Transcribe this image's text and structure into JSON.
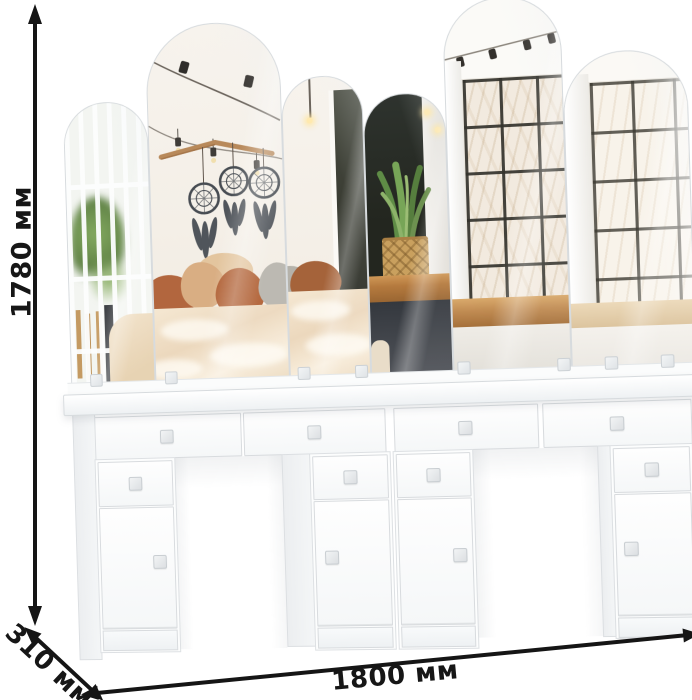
{
  "image_type": "furniture product photo with dimension annotations",
  "dimensions": {
    "height_label": "1780 мм",
    "depth_label": "310 мм",
    "width_label": "1800 мм"
  },
  "product": {
    "kind": "white double dressing table (vanity) with arched mirror panels",
    "mirror_panels": 6,
    "apron_drawers": 4,
    "pedestals": 4,
    "pedestal_drawers": 4,
    "pedestal_doors": 4,
    "knob_style": "small square acrylic knobs"
  },
  "reflection_scene": {
    "left": "white slatted screen with green houseplant and bamboo poles",
    "center": "white brick wall, string lights, wooden branch with three dreamcatchers, bed with beige and terracotta pillows",
    "right": "dark wall, snake plant in wicker basket on wooden window bench, black grid window with pale trees outside"
  },
  "colors": {
    "background": "#ffffff",
    "furniture_white": "#fcfdfd",
    "outline_gray": "#d8dbde",
    "dimension_line": "#151515",
    "mirror_wall": "#f5f1ea",
    "dark_wall": "#2a2e2a",
    "wood_bench": "#b5763c",
    "branch_wood": "#b8895a",
    "plant_green": "#6d9150",
    "basket_tan": "#c9a05e",
    "pillow_terracotta": "#b2663e",
    "pillow_beige": "#d9ae83",
    "pillow_gray": "#b8b5ad",
    "blanket_beige": "#eedcc6",
    "dreamcatcher_gray": "#4a4f55",
    "window_light": "#f2eadf",
    "window_grid": "#34332d"
  }
}
